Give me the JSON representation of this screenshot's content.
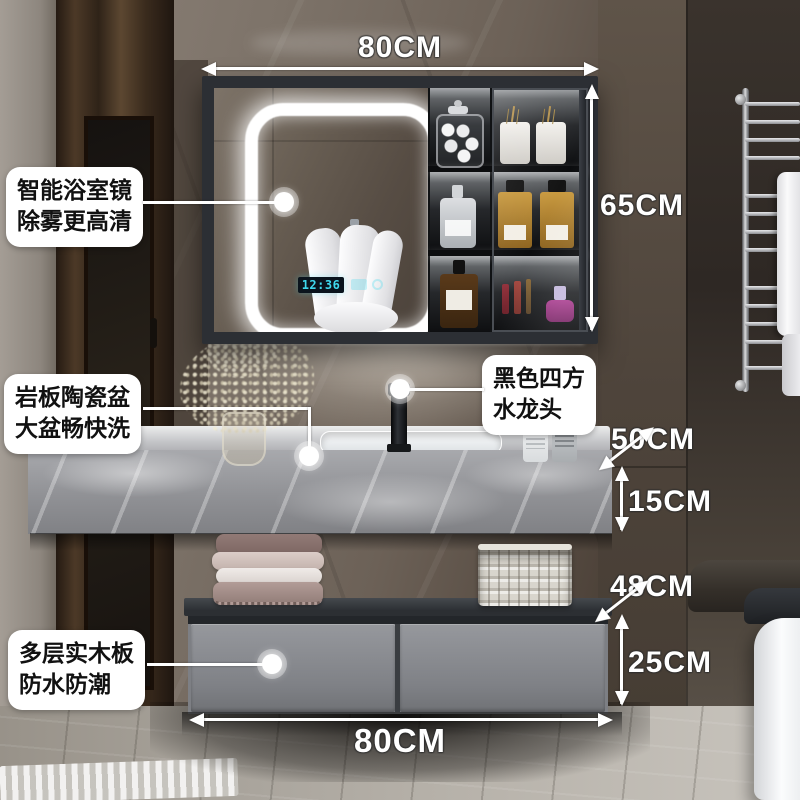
{
  "feature_labels": [
    {
      "line1": "智能浴室镜",
      "line2": "除雾更高清"
    },
    {
      "line1": "岩板陶瓷盆",
      "line2": "大盆畅快洗"
    },
    {
      "line1": "黑色四方",
      "line2": "水龙头"
    },
    {
      "line1": "多层实木板",
      "line2": "防水防潮"
    }
  ],
  "dimensions": {
    "mirror_width": "80CM",
    "mirror_height": "65CM",
    "counter_depth": "50CM",
    "counter_thickness": "15CM",
    "cabinet_depth": "48CM",
    "cabinet_height": "25CM",
    "cabinet_width": "80CM"
  },
  "mirror_display": {
    "time": "12:36"
  },
  "colors": {
    "annotation_text": "#ffffff",
    "label_background": "#ffffff",
    "label_text": "#111111",
    "clock_digits": "#3fd9ee",
    "led_glow": "#ffffff",
    "vanity_gray": "#7d7f84",
    "counter_marble": "#96979b",
    "wall_marble_brown": "#6c6157"
  }
}
